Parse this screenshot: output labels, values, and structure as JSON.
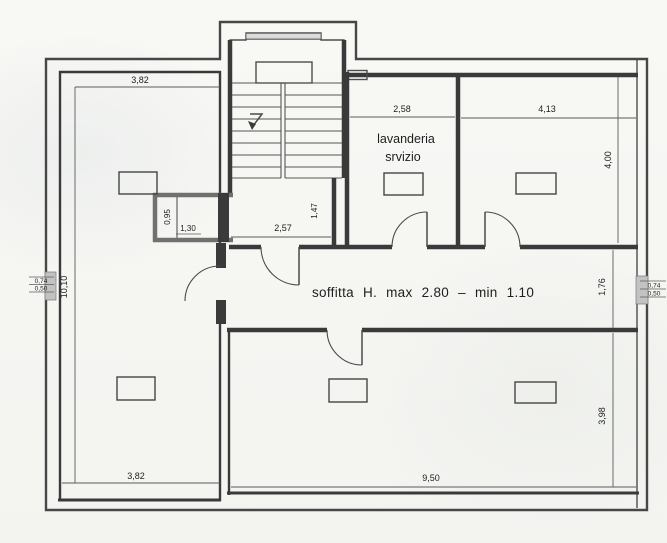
{
  "plan": {
    "soffitta_note": "soffitta H. max 2.80 – min 1.10",
    "laundry_room": {
      "line1": "lavanderia",
      "line2": "srvizio"
    }
  },
  "dims": {
    "left_width_top": "3,82",
    "left_width_bottom": "3,82",
    "left_height": "10,10",
    "laundry_width": "2,58",
    "right_room_width": "4,13",
    "right_room_depth": "4,00",
    "closet_depth": "0,95",
    "closet_width": "1,30",
    "hall_width": "2,57",
    "hall_depth": "1,47",
    "corridor_depth": "1,76",
    "bottom_room_width": "9,50",
    "bottom_room_depth": "3,98",
    "window_left_width": "0,74",
    "window_left_sill": "0,50",
    "window_right_width": "0,74",
    "window_right_sill": "0,50"
  },
  "colors": {
    "wall": "#3a3a3a",
    "partition": "#707070",
    "dim_line": "#5b5b5b",
    "ink": "#1e1e1e",
    "paper": "#f6f6f3",
    "window_fill": "#c2c2c2"
  }
}
